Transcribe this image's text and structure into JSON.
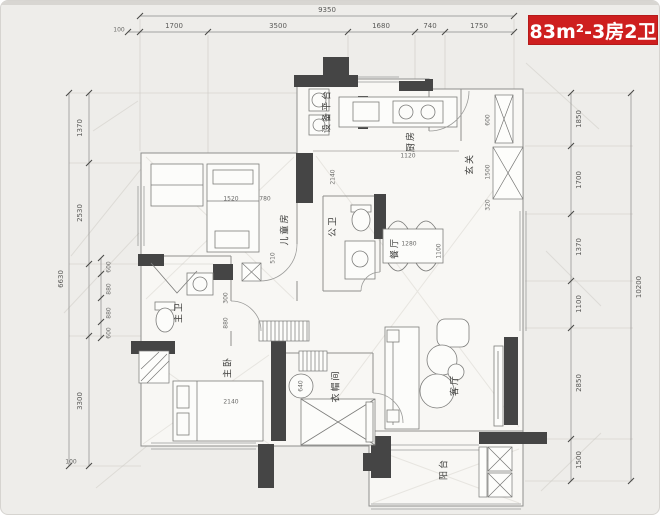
{
  "badge": {
    "text": "83m²-3房2卫",
    "bg": "#ce1f1f",
    "fg": "#ffffff"
  },
  "rooms": {
    "equipment_platform": "设备平台",
    "kitchen": "厨房",
    "entry": "玄关",
    "kids_room": "儿童房",
    "guest_bath": "公卫",
    "dining": "餐厅",
    "master_bath": "主卫",
    "master_bedroom": "主卧",
    "cloakroom": "衣帽间",
    "living": "客厅",
    "balcony": "阳台"
  },
  "dims": {
    "top": {
      "overall": "9350",
      "s1": "1700",
      "s2": "3500",
      "s3": "1680",
      "s4": "740",
      "s5": "1750",
      "corner": "100"
    },
    "right": {
      "overall": "10200",
      "s1": "1850",
      "s2": "1700",
      "s3": "1370",
      "s4": "1100",
      "s5": "2850",
      "s6": "1500"
    },
    "left": {
      "overall": "6630",
      "s1": "1370",
      "s2": "2530",
      "s3": "3300",
      "sub1": "600",
      "sub2": "880",
      "sub3": "880",
      "sub4": "600",
      "corner": "100"
    },
    "interior": {
      "i1": "1520",
      "i2": "780",
      "i3": "510",
      "i4": "2140",
      "i5": "1120",
      "i6": "1100",
      "i7": "1280",
      "i8": "300",
      "i9": "880",
      "i10": "2140",
      "i11": "640",
      "i12": "600",
      "i13": "1500",
      "i14": "320"
    }
  },
  "colors": {
    "wall": "#454545",
    "line": "#8f8f8f",
    "paper": "#f8f7f4",
    "dim_text": "#5a5a58"
  }
}
